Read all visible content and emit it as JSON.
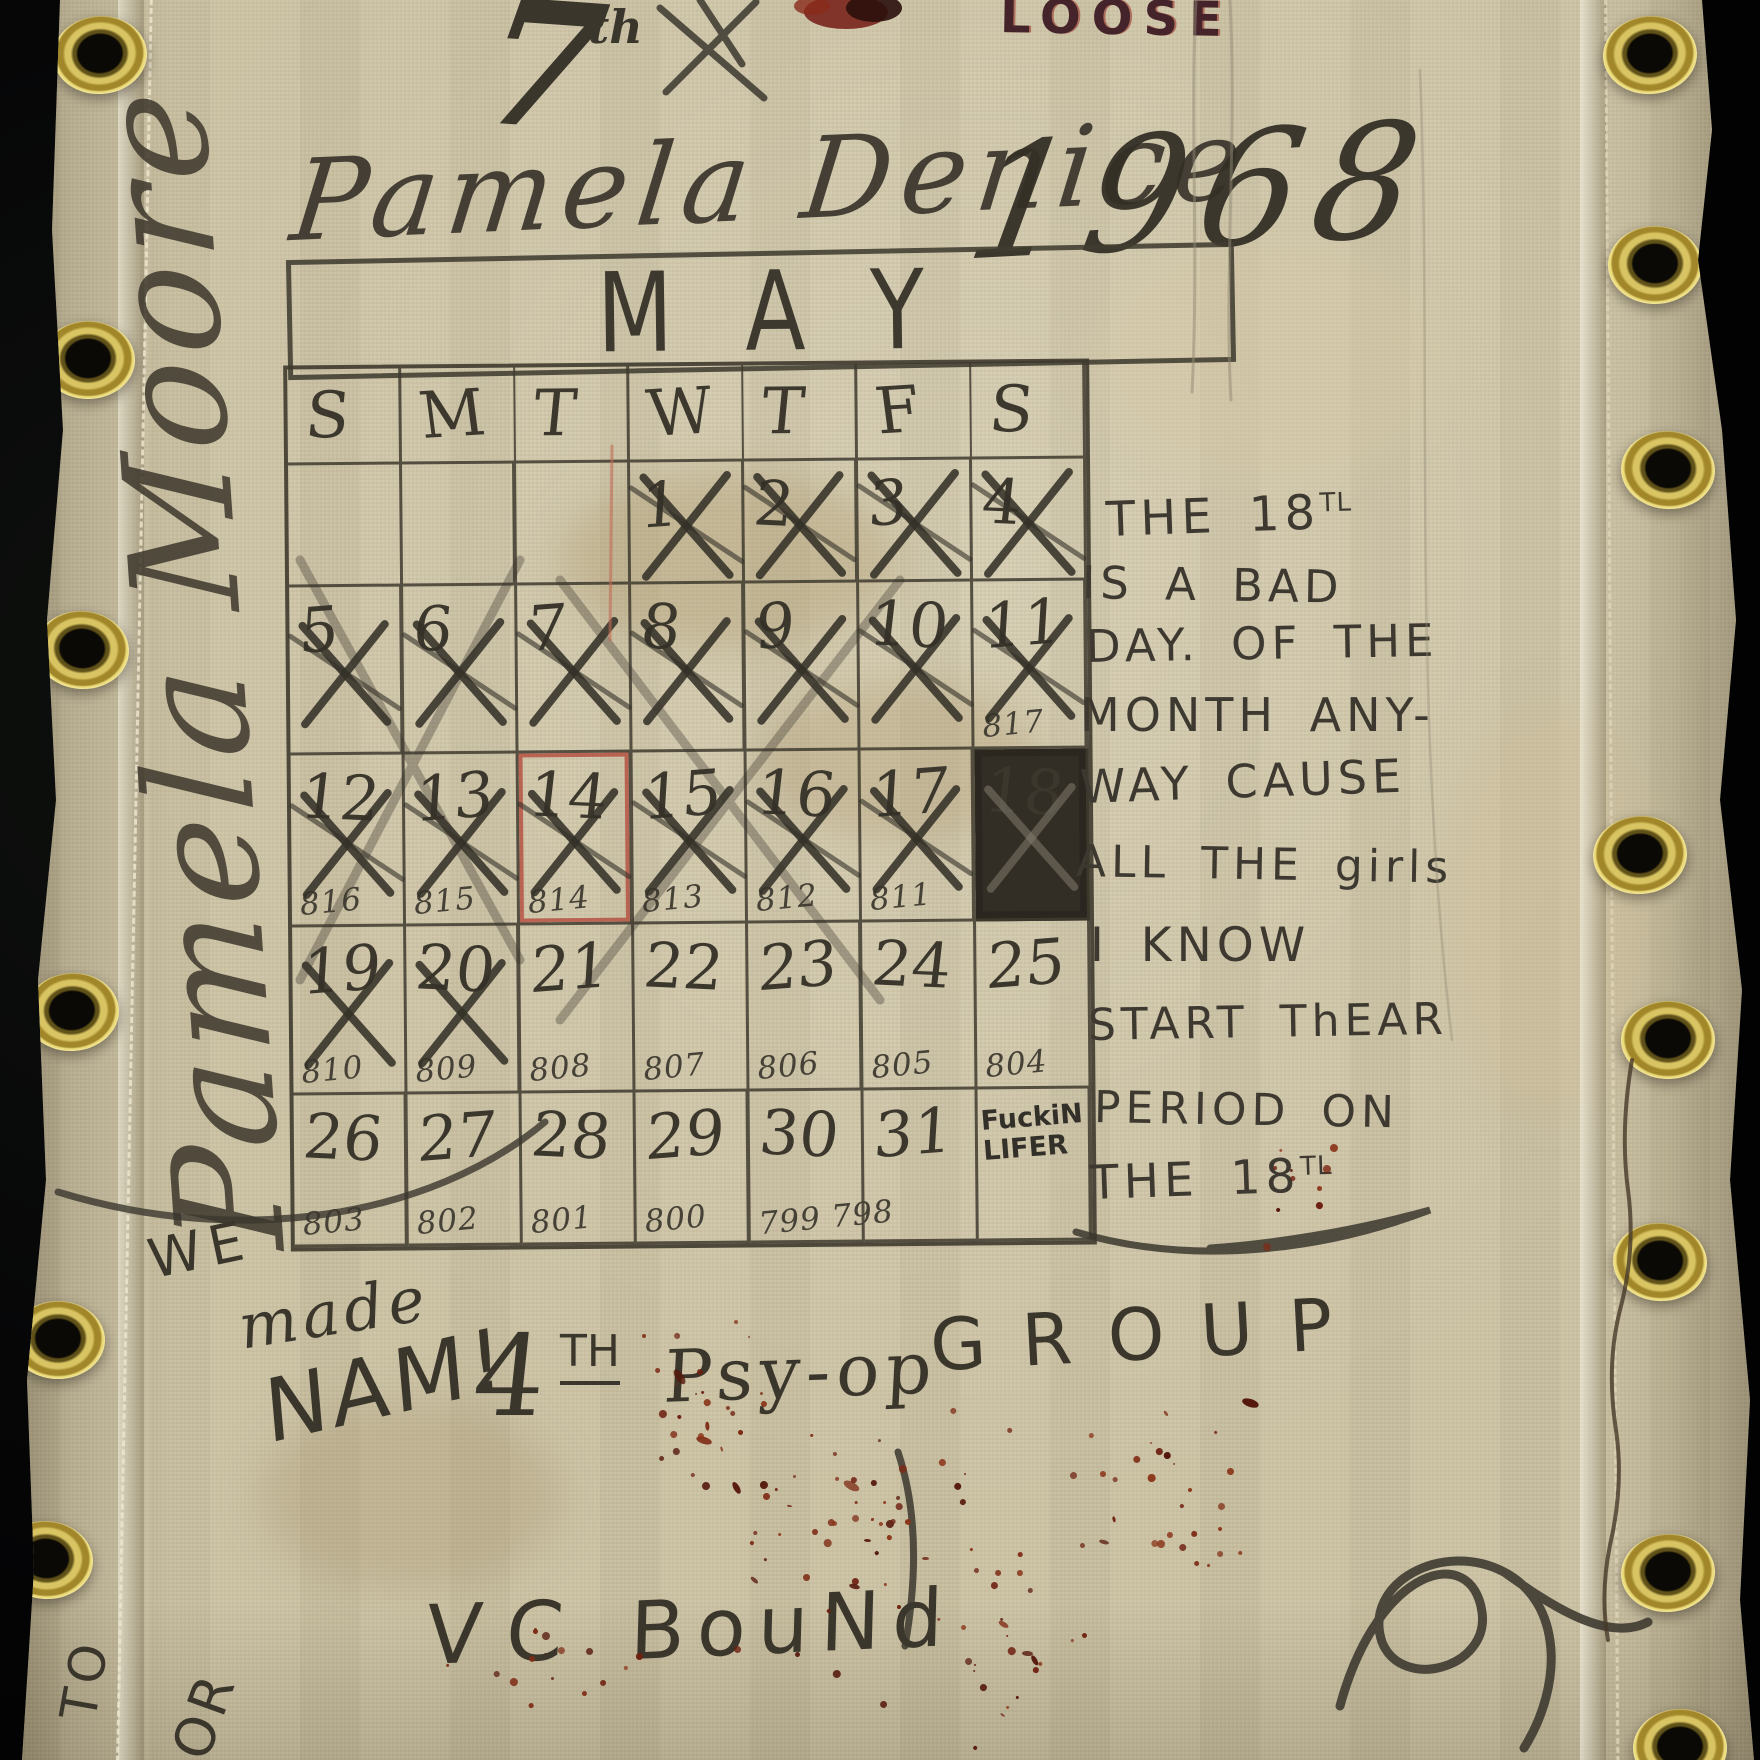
{
  "palette": {
    "canvas": "#cbc1a3",
    "ink": "#3c382f",
    "red_ink": "#a33a2e",
    "blood": "#6d1f10",
    "brass": "#c9b254",
    "loose_ink": "#45232a"
  },
  "top": {
    "seven": "7",
    "seven_sup": "th",
    "loose": "LOOSE",
    "name_script": "Pamela Denice",
    "year": "1968",
    "vertical_signature": "Pamela Moore"
  },
  "calendar": {
    "month": "MAY",
    "day_headers": [
      "S",
      "M",
      "T",
      "W",
      "T",
      "F",
      "S"
    ],
    "weeks": [
      [
        {
          "d": ""
        },
        {
          "d": ""
        },
        {
          "d": ""
        },
        {
          "d": "1",
          "x": 1
        },
        {
          "d": "2",
          "x": 1
        },
        {
          "d": "3",
          "x": 1
        },
        {
          "d": "4",
          "x": 1
        }
      ],
      [
        {
          "d": "5",
          "x": 1
        },
        {
          "d": "6",
          "x": 1
        },
        {
          "d": "7",
          "x": 1
        },
        {
          "d": "8",
          "x": 1
        },
        {
          "d": "9",
          "x": 1
        },
        {
          "d": "10",
          "x": 1
        },
        {
          "d": "11",
          "x": 1,
          "sub": "817"
        }
      ],
      [
        {
          "d": "12",
          "x": 1,
          "sub": "816"
        },
        {
          "d": "13",
          "x": 1,
          "sub": "815"
        },
        {
          "d": "14",
          "x": 1,
          "sub": "814",
          "red": 1
        },
        {
          "d": "15",
          "x": 1,
          "sub": "813"
        },
        {
          "d": "16",
          "x": 1,
          "sub": "812"
        },
        {
          "d": "17",
          "x": 1,
          "sub": "811"
        },
        {
          "d": "18",
          "filled": 1
        }
      ],
      [
        {
          "d": "19",
          "x": 1,
          "sub": "810"
        },
        {
          "d": "20",
          "x": 1,
          "sub": "809"
        },
        {
          "d": "21",
          "sub": "808"
        },
        {
          "d": "22",
          "sub": "807"
        },
        {
          "d": "23",
          "sub": "806"
        },
        {
          "d": "24",
          "sub": "805"
        },
        {
          "d": "25",
          "sub": "804"
        }
      ],
      [
        {
          "d": "26",
          "sub": "803"
        },
        {
          "d": "27",
          "sub": "802"
        },
        {
          "d": "28",
          "sub": "801"
        },
        {
          "d": "29",
          "sub": "800"
        },
        {
          "d": "30",
          "sub": "799 798"
        },
        {
          "d": "31"
        },
        {
          "d": "",
          "note": "FuckiN LIFER"
        }
      ]
    ]
  },
  "side_note": {
    "lines": [
      {
        "text": "THE 18",
        "sup": "TL"
      },
      {
        "text": "IS A BAD"
      },
      {
        "text": "DAY. OF THE"
      },
      {
        "text": "MONTH ANY-"
      },
      {
        "text": "WAY CAUSE"
      },
      {
        "text": "ALL THE girls"
      },
      {
        "text": "I KNOW"
      },
      {
        "text": "START ThEAR"
      },
      {
        "text": "PERIOD ON"
      },
      {
        "text": "THE 18",
        "sup": "TL"
      }
    ]
  },
  "bottom": {
    "we": "WE",
    "made": "made",
    "nam": "NAM!",
    "four": "4",
    "four_sup": "TH",
    "psyop": "Psy-op",
    "group": "GROUP",
    "vc": "VC",
    "bound": "BouNd",
    "to": "TO",
    "or": "OR"
  }
}
